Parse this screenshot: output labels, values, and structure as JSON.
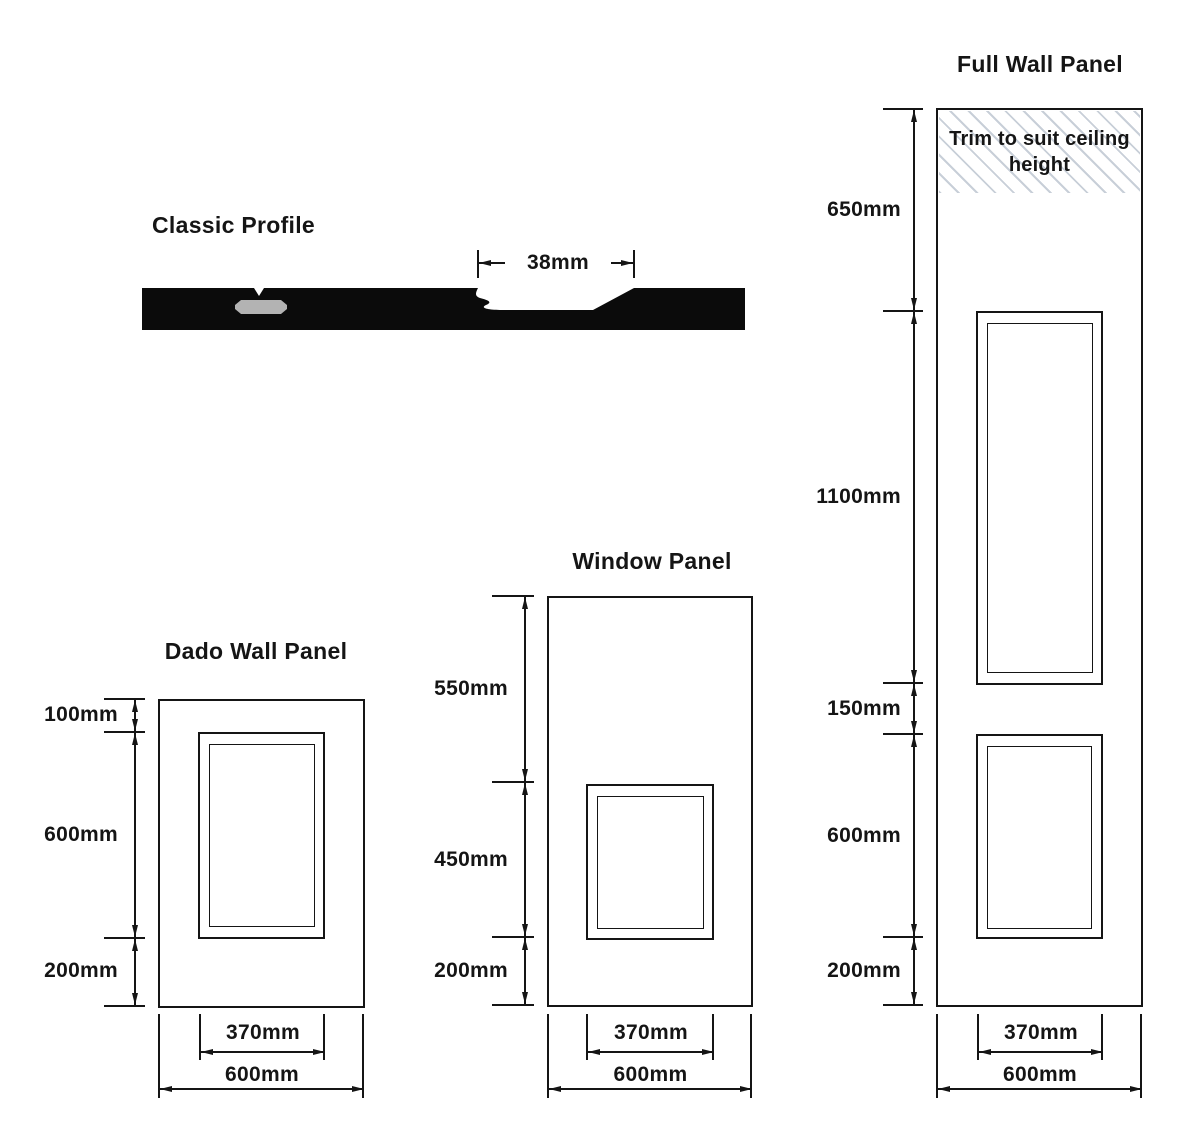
{
  "classic_profile": {
    "title": "Classic Profile",
    "groove_width": "38mm"
  },
  "dado_panel": {
    "title": "Dado Wall Panel",
    "height_dims": [
      "100mm",
      "600mm",
      "200mm"
    ],
    "width_dims": [
      "370mm",
      "600mm"
    ]
  },
  "window_panel": {
    "title": "Window Panel",
    "height_dims": [
      "550mm",
      "450mm",
      "200mm"
    ],
    "width_dims": [
      "370mm",
      "600mm"
    ]
  },
  "full_panel": {
    "title": "Full Wall Panel",
    "trim_note": "Trim to suit ceiling height",
    "height_dims": [
      "650mm",
      "1100mm",
      "150mm",
      "600mm",
      "200mm"
    ],
    "width_dims": [
      "370mm",
      "600mm"
    ]
  },
  "colors": {
    "line": "#151515",
    "hatch_line": "#c8cfd8",
    "profile_fill": "#0b0b0b",
    "biscuit_slot": "#b3b3b3",
    "background": "#ffffff"
  }
}
